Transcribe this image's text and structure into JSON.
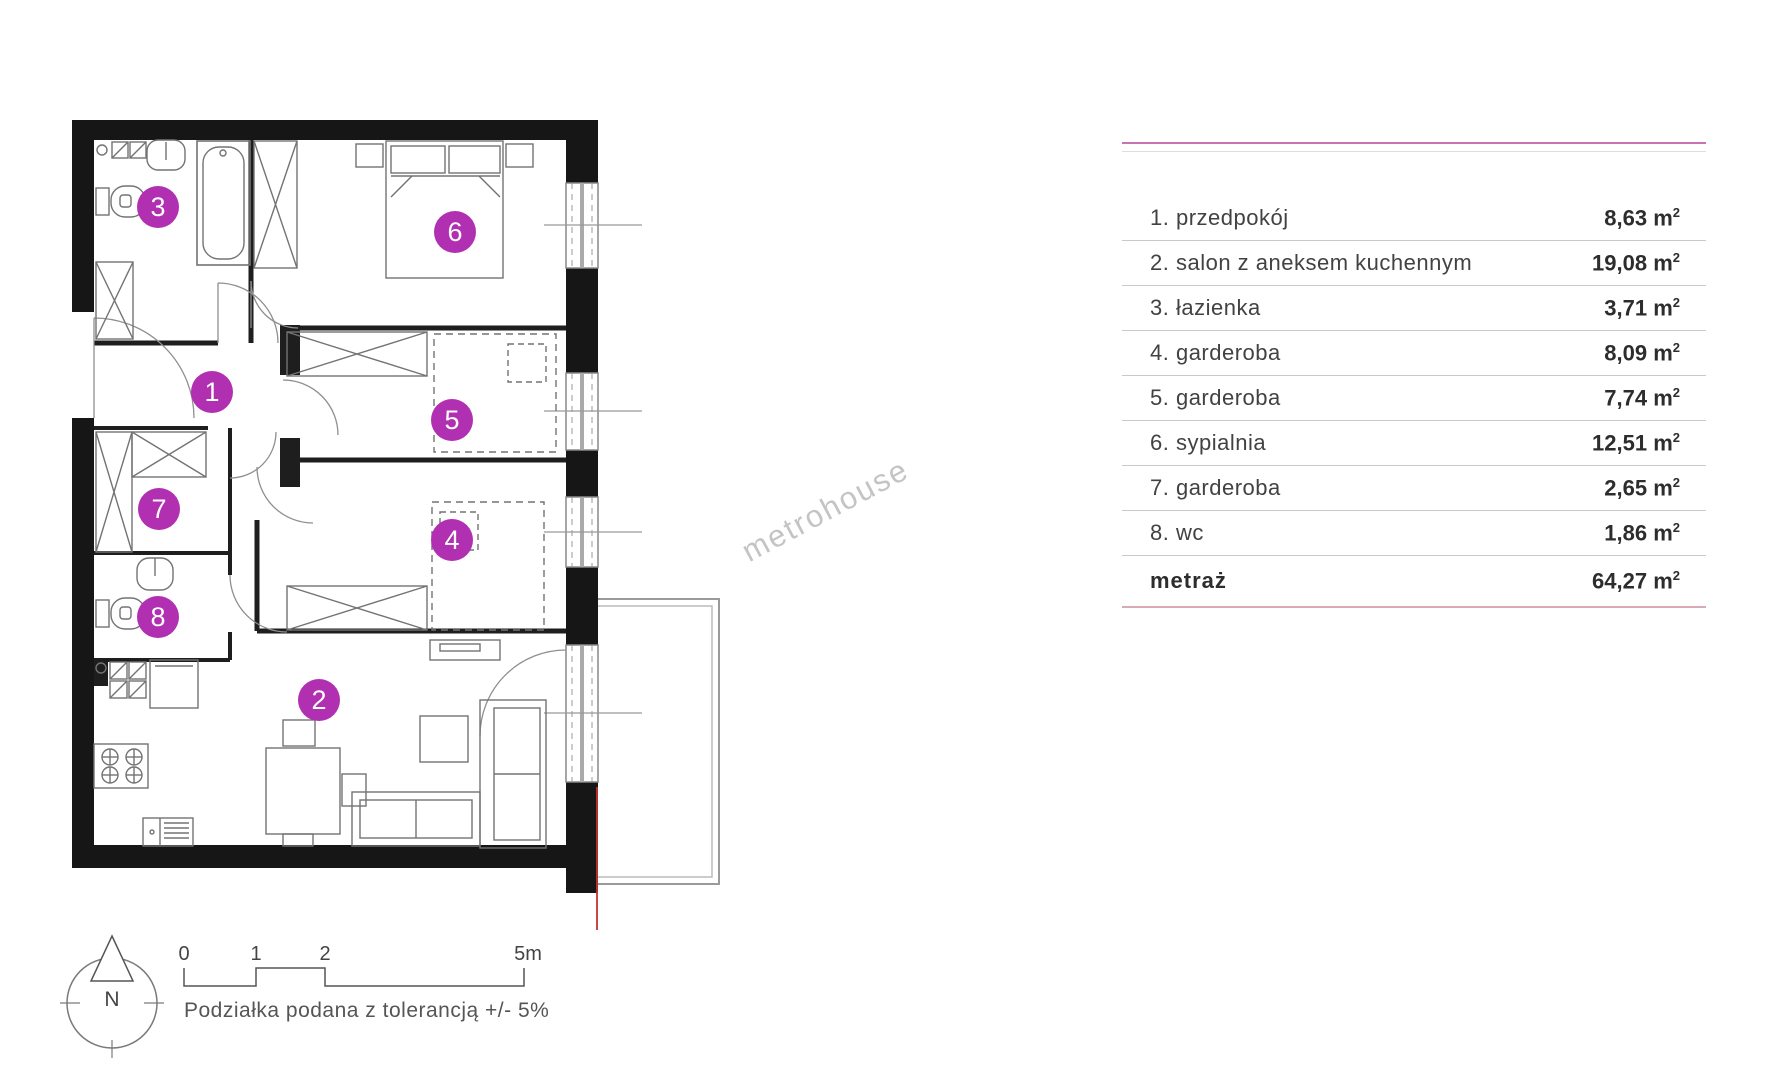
{
  "floor_plan": {
    "accent_color": "#b12fb1",
    "rooms": [
      {
        "number": "1",
        "x": 212,
        "y": 392
      },
      {
        "number": "2",
        "x": 319,
        "y": 700
      },
      {
        "number": "3",
        "x": 158,
        "y": 207
      },
      {
        "number": "4",
        "x": 452,
        "y": 540
      },
      {
        "number": "5",
        "x": 452,
        "y": 420
      },
      {
        "number": "6",
        "x": 455,
        "y": 232
      },
      {
        "number": "7",
        "x": 159,
        "y": 509
      },
      {
        "number": "8",
        "x": 158,
        "y": 617
      }
    ]
  },
  "legend": {
    "unit": "m",
    "unit_sup": "2",
    "rows": [
      {
        "label": "1. przedpokój",
        "area": "8,63"
      },
      {
        "label": "2. salon z aneksem kuchennym",
        "area": "19,08"
      },
      {
        "label": "3. łazienka",
        "area": "3,71"
      },
      {
        "label": "4. garderoba",
        "area": "8,09"
      },
      {
        "label": "5. garderoba",
        "area": "7,74"
      },
      {
        "label": "6. sypialnia",
        "area": "12,51"
      },
      {
        "label": "7. garderoba",
        "area": "2,65"
      },
      {
        "label": "8. wc",
        "area": "1,86"
      },
      {
        "label": "metraż",
        "area": "64,27"
      }
    ]
  },
  "compass": {
    "label": "N"
  },
  "scale_bar": {
    "ticks": [
      "0",
      "1",
      "2",
      "5m"
    ],
    "note": "Podziałka podana z tolerancją +/- 5%"
  },
  "watermark": {
    "text": "metrohouse"
  }
}
